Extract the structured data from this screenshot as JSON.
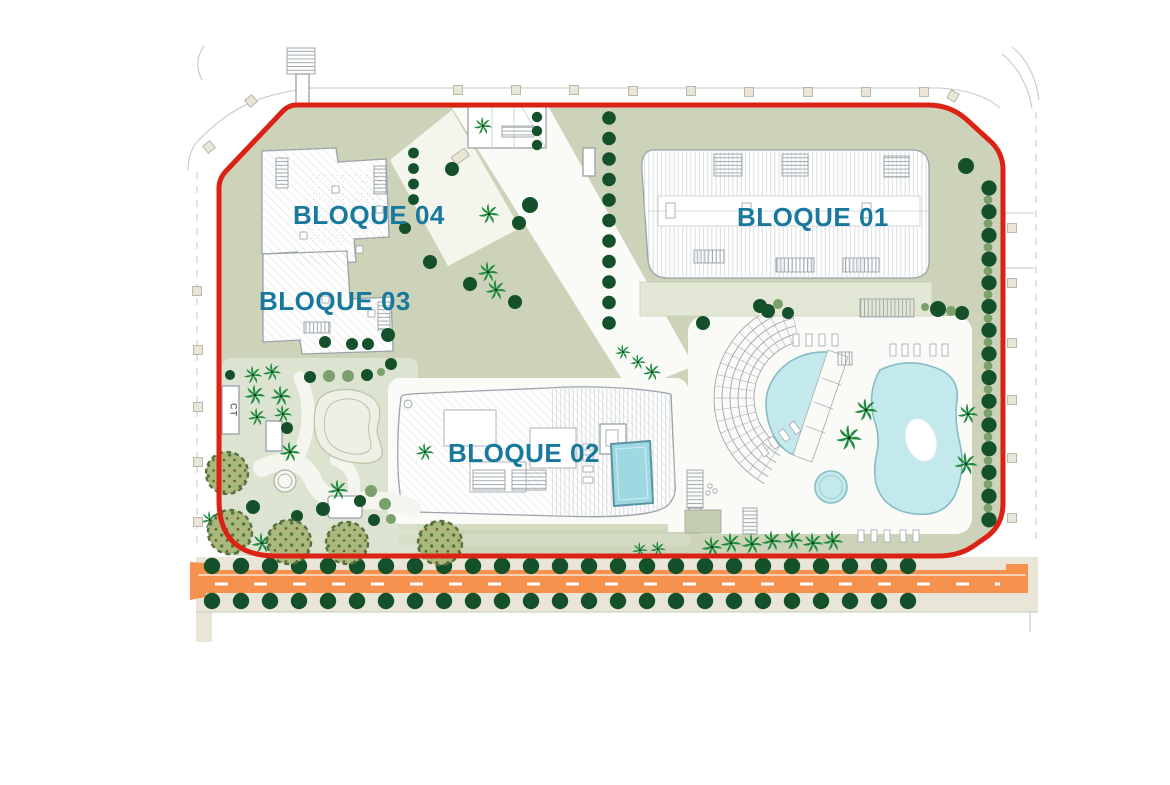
{
  "labels": {
    "bloque01": "BLOQUE 01",
    "bloque02": "BLOQUE 02",
    "bloque03": "BLOQUE 03",
    "bloque04": "BLOQUE 04",
    "ct": "CT"
  },
  "colors": {
    "page_bg": "#ffffff",
    "site_green": "#ccd3b9",
    "garden_green": "#dde3d1",
    "lawn_light": "#d7dec8",
    "deck_white": "#fafbf7",
    "boundary_red": "#dc2215",
    "road_orange": "#f6914e",
    "road_marking": "#ffffff",
    "sidewalk_beige": "#e9e6d7",
    "kerb_gray": "#c6c9c2",
    "building_fill": "#ffffff",
    "building_stroke": "#98a1a7",
    "hatch_gray": "#ccd3d7",
    "rung_gray": "#a3abb1",
    "pool_blue": "#c4e9ec",
    "pool_edge": "#86bcc3",
    "rooftop_pool_blue": "#9ed8e0",
    "rooftop_pool_edge": "#5c93a2",
    "tree_dark_green": "#14512a",
    "tree_olive_green": "#7aa06b",
    "palm_green": "#1f8c3f",
    "bush_green": "#a8b97b",
    "bush_speckle": "#55703f",
    "label_teal": "#18789e",
    "ct_text_gray": "#6a6f66"
  },
  "landscape": {
    "street_tree_rows": [
      {
        "y": 566,
        "x0": 212,
        "x1": 922,
        "step": 29,
        "r": 8.2
      },
      {
        "y": 601,
        "x0": 212,
        "x1": 922,
        "step": 29,
        "r": 8.2
      }
    ],
    "tree_columns": [
      {
        "x": 609,
        "y0": 118,
        "y1": 343,
        "step": 20.5,
        "r": 6.8
      },
      {
        "x": 989,
        "y0": 188,
        "y1": 520,
        "step": 23.7,
        "r": 7.6,
        "alt_r": 4.4
      },
      {
        "x": 413.5,
        "y0": 153,
        "y1": 200,
        "step": 15.5,
        "r": 5.4
      },
      {
        "x": 537,
        "y0": 117,
        "y1": 145,
        "step": 14,
        "r": 5.2
      }
    ],
    "trees": [
      [
        483,
        126,
        7,
        "p"
      ],
      [
        489,
        214,
        8,
        "p"
      ],
      [
        488,
        272,
        8,
        "p"
      ],
      [
        496,
        290,
        8,
        "p"
      ],
      [
        866,
        410,
        9,
        "p"
      ],
      [
        849,
        438,
        10,
        "p"
      ],
      [
        968,
        414,
        8,
        "p"
      ],
      [
        966,
        464,
        9,
        "p"
      ],
      [
        640,
        550,
        6,
        "p"
      ],
      [
        658,
        549,
        6,
        "p"
      ],
      [
        712,
        547,
        8,
        "p"
      ],
      [
        731,
        543,
        8,
        "p"
      ],
      [
        752,
        544,
        8,
        "p"
      ],
      [
        772,
        541,
        8,
        "p"
      ],
      [
        793,
        540,
        8,
        "p"
      ],
      [
        813,
        543,
        8,
        "p"
      ],
      [
        833,
        541,
        8,
        "p"
      ],
      [
        253,
        375,
        7,
        "p"
      ],
      [
        272,
        372,
        7,
        "p"
      ],
      [
        255,
        395,
        8,
        "p"
      ],
      [
        281,
        396,
        8,
        "p"
      ],
      [
        257,
        417,
        7,
        "p"
      ],
      [
        283,
        414,
        7,
        "p"
      ],
      [
        290,
        452,
        8,
        "p"
      ],
      [
        338,
        490,
        8,
        "p"
      ],
      [
        425,
        452,
        7,
        "p"
      ],
      [
        262,
        543,
        8,
        "p"
      ],
      [
        210,
        520,
        7,
        "p"
      ],
      [
        623,
        352,
        6,
        "p"
      ],
      [
        638,
        362,
        6,
        "p"
      ],
      [
        652,
        372,
        7,
        "p"
      ],
      [
        452,
        169,
        7,
        "d"
      ],
      [
        530,
        205,
        8,
        "d"
      ],
      [
        519,
        223,
        7,
        "d"
      ],
      [
        405,
        228,
        6,
        "d"
      ],
      [
        430,
        262,
        7,
        "d"
      ],
      [
        470,
        284,
        7,
        "d"
      ],
      [
        515,
        302,
        7,
        "d"
      ],
      [
        325,
        342,
        6,
        "d"
      ],
      [
        352,
        344,
        6,
        "d"
      ],
      [
        368,
        344,
        6,
        "d"
      ],
      [
        388,
        335,
        7,
        "d"
      ],
      [
        703,
        323,
        7,
        "d"
      ],
      [
        760,
        306,
        7,
        "d"
      ],
      [
        768,
        311,
        7,
        "d"
      ],
      [
        788,
        313,
        6,
        "d"
      ],
      [
        938,
        309,
        8,
        "d"
      ],
      [
        962,
        313,
        7,
        "d"
      ],
      [
        966,
        166,
        8,
        "d"
      ],
      [
        230,
        375,
        5,
        "d"
      ],
      [
        310,
        377,
        6,
        "d"
      ],
      [
        367,
        375,
        6,
        "d"
      ],
      [
        391,
        364,
        6,
        "d"
      ],
      [
        287,
        428,
        6,
        "d"
      ],
      [
        253,
        507,
        7,
        "d"
      ],
      [
        297,
        516,
        6,
        "d"
      ],
      [
        323,
        509,
        7,
        "d"
      ],
      [
        360,
        501,
        6,
        "d"
      ],
      [
        374,
        520,
        6,
        "d"
      ],
      [
        951,
        311,
        5,
        "o"
      ],
      [
        925,
        307,
        4,
        "o"
      ],
      [
        329,
        376,
        6,
        "o"
      ],
      [
        348,
        376,
        6,
        "o"
      ],
      [
        381,
        372,
        4,
        "o"
      ],
      [
        371,
        491,
        6,
        "o"
      ],
      [
        385,
        504,
        6,
        "o"
      ],
      [
        391,
        519,
        5,
        "o"
      ],
      [
        778,
        304,
        5,
        "o"
      ],
      [
        227,
        473,
        21,
        "b"
      ],
      [
        230,
        532,
        22,
        "b"
      ],
      [
        289,
        542,
        22,
        "b"
      ],
      [
        347,
        543,
        21,
        "b"
      ],
      [
        440,
        543,
        22,
        "b"
      ]
    ]
  },
  "road": {
    "dash_len": 13,
    "dash_gap": 26
  }
}
